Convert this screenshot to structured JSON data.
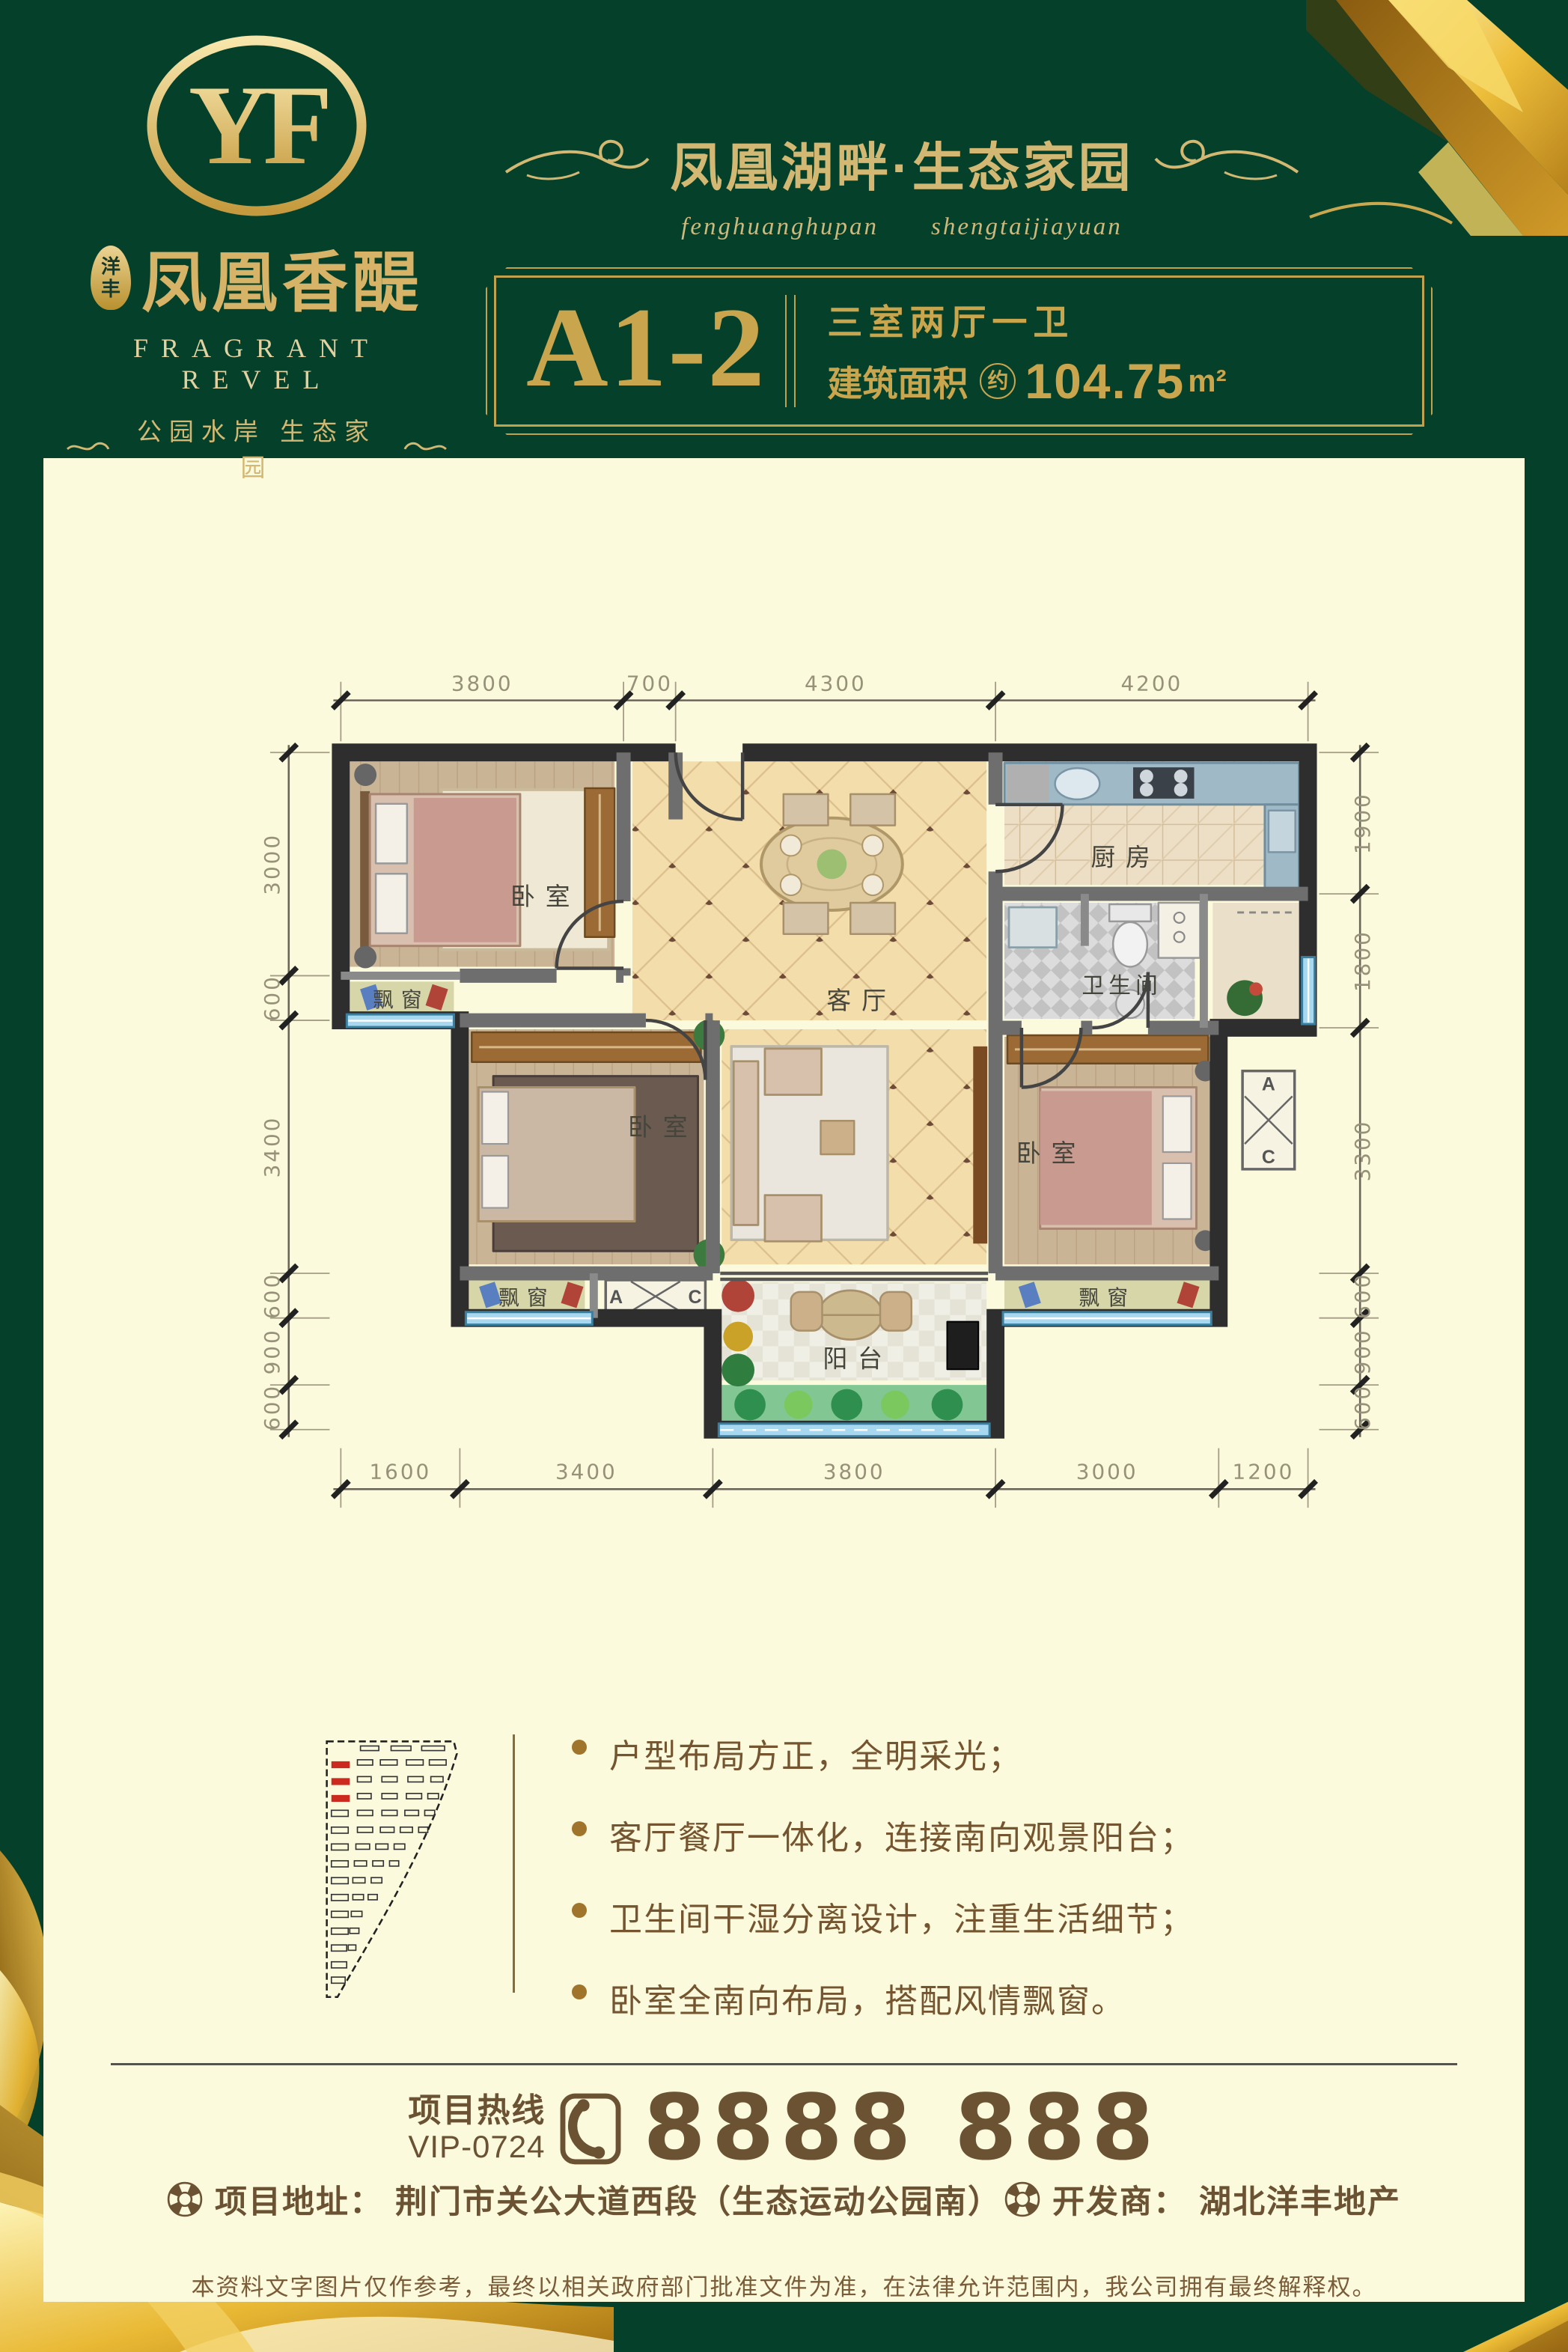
{
  "brand": {
    "monogram": "YF",
    "seal_line1": "洋",
    "seal_line2": "丰",
    "name_cn": "凤凰香醍",
    "name_en": "FRAGRANT REVEL",
    "slogan": "公园水岸 生态家园"
  },
  "header": {
    "title": "凤凰湖畔·生态家园",
    "pinyin_1": "fenghuanghupan",
    "pinyin_2": "shengtaijiayuan"
  },
  "unit": {
    "code": "A1-2",
    "rooms": "三室两厅一卫",
    "area_label": "建筑面积",
    "area_approx": "约",
    "area_value": "104.75",
    "area_unit": "m²"
  },
  "plan": {
    "labels": {
      "bedroom": "卧室",
      "living": "客厅",
      "kitchen": "厨房",
      "bathroom": "卫生间",
      "balcony": "阳台",
      "bay_window": "飘窗",
      "ac_a": "A",
      "ac_c": "C"
    },
    "dims_top": [
      "3800",
      "700",
      "4300",
      "4200"
    ],
    "dims_bottom": [
      "1600",
      "3400",
      "3800",
      "3000",
      "1200"
    ],
    "dims_left": [
      "3000",
      "600",
      "3400",
      "600",
      "900",
      "600"
    ],
    "dims_right": [
      "1900",
      "1800",
      "3300",
      "600",
      "900",
      "600"
    ]
  },
  "features": [
    "户型布局方正，全明采光；",
    "客厅餐厅一体化，连接南向观景阳台；",
    "卫生间干湿分离设计，注重生活细节；",
    "卧室全南向布局，搭配风情飘窗。"
  ],
  "footer": {
    "hotline_label": "项目热线",
    "hotline_vip": "VIP-0724",
    "hotline_number": "8888 888",
    "address_label": "项目地址：",
    "address_value": "荆门市关公大道西段（生态运动公园南）",
    "developer_label": "开发商：",
    "developer_value": "湖北洋丰地产",
    "disclaimer": "本资料文字图片仅作参考，最终以相关政府部门批准文件为准，在法律允许范围内，我公司拥有最终解释权。"
  },
  "colors": {
    "green": "#04402a",
    "gold": "#c9a54d",
    "cream": "#fcfadd",
    "brown": "#6b5233"
  }
}
